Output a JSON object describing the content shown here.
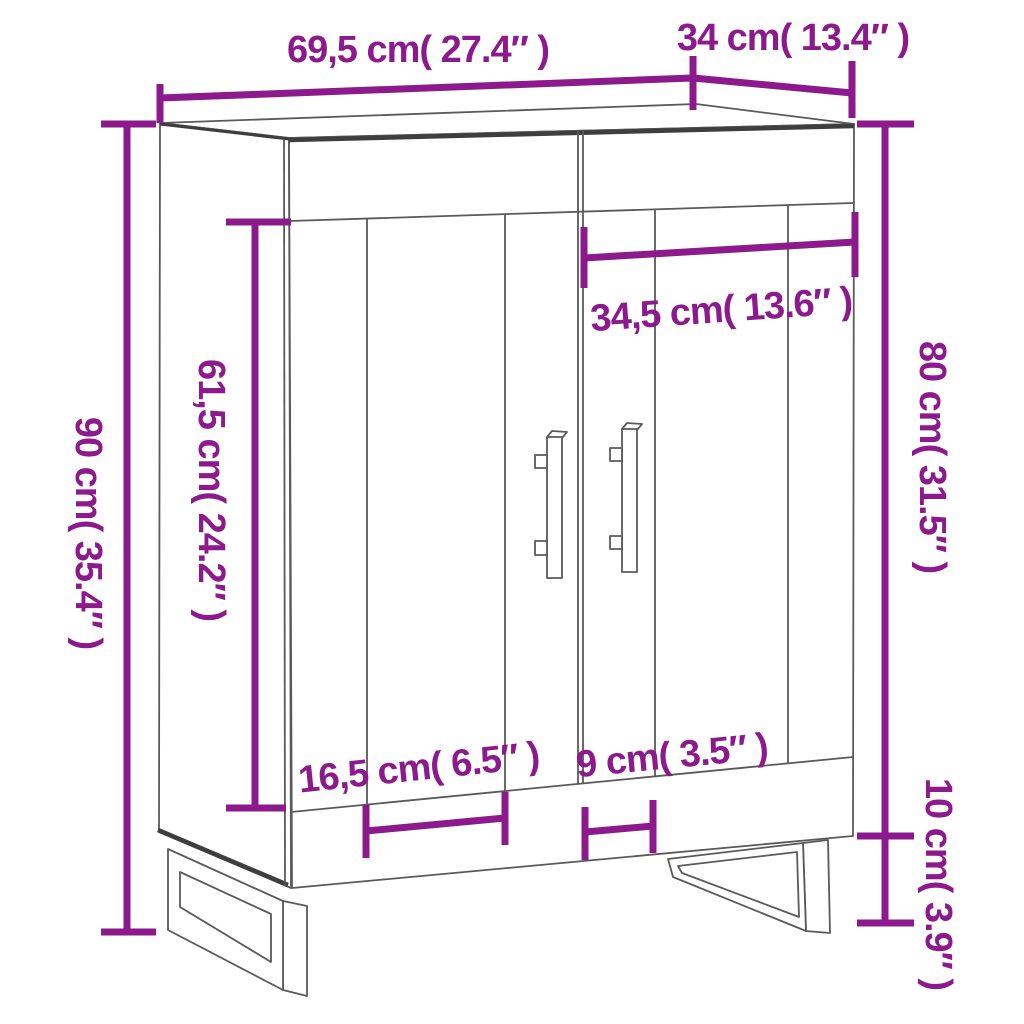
{
  "diagram": {
    "kind": "furniture-dimension-diagram",
    "subject": "sideboard with two doors, top drawer band and sled legs",
    "background": "white",
    "units": [
      "cm",
      "inch"
    ]
  },
  "colors": {
    "accent": "#8c1a8c",
    "line": "#5a5a5a",
    "line_dark": "#3e3e3e",
    "background": "#ffffff"
  },
  "dims": {
    "width": {
      "label": "69,5 cm( 27.4″ )",
      "cm": "69,5",
      "inch": "27.4",
      "orientation": "horizontal-top"
    },
    "depth": {
      "label": "34 cm( 13.4″ )",
      "cm": "34",
      "inch": "13.4",
      "orientation": "horizontal-top"
    },
    "height": {
      "label": "90 cm( 35.4″ )",
      "cm": "90",
      "inch": "35.4",
      "orientation": "vertical-left"
    },
    "door_height": {
      "label": "61,5 cm( 24.2″ )",
      "cm": "61,5",
      "inch": "24.2",
      "orientation": "vertical-inner-left"
    },
    "right_section_width": {
      "label": "34,5 cm( 13.6″ )",
      "cm": "34,5",
      "inch": "13.6",
      "orientation": "horizontal-inner"
    },
    "body_height": {
      "label": "80 cm( 31.5″ )",
      "cm": "80",
      "inch": "31.5",
      "orientation": "vertical-right"
    },
    "door_panel_width": {
      "label": "16,5 cm( 6.5″ )",
      "cm": "16,5",
      "inch": "6.5",
      "orientation": "horizontal-bottom"
    },
    "panel_gap_width": {
      "label": "9 cm( 3.5″ )",
      "cm": "9",
      "inch": "3.5",
      "orientation": "horizontal-bottom"
    },
    "leg_height": {
      "label": "10 cm( 3.9″ )",
      "cm": "10",
      "inch": "3.9",
      "orientation": "vertical-right-bottom"
    }
  }
}
